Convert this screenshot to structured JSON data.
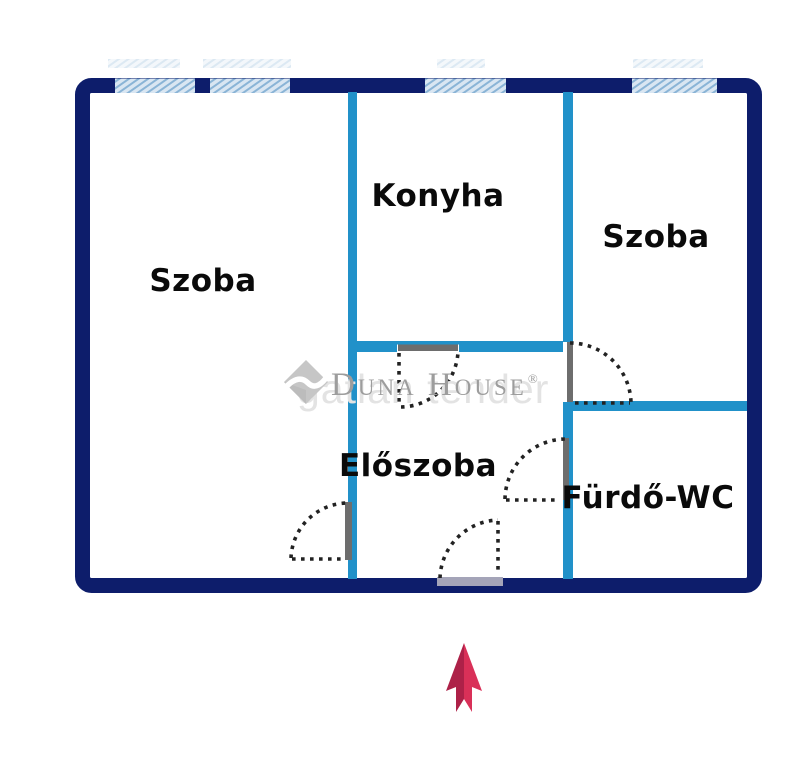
{
  "floorplan_title": "2 szoba lakás alaprajz",
  "rooms": [
    {
      "name": "Szoba"
    },
    {
      "name": "Konyha"
    },
    {
      "name": "Szoba"
    },
    {
      "name": "Előszoba"
    },
    {
      "name": "Fürdő-WC"
    }
  ],
  "watermark": {
    "brand": "Duna House",
    "registered": "®",
    "ghost": "gatlan tender"
  },
  "colors": {
    "outer_wall": "#0d1d6b",
    "inner_wall": "#2191c9",
    "window_fill": "#d9e6f2",
    "window_stripe": "#8ab4d6",
    "door_leaf": "#6d6d6d",
    "door_swing_dots": "#222222",
    "entrance_sill": "#a4a4b8",
    "label_text": "#0a0a0a",
    "watermark_gray": "#9d9d9d",
    "arrow_dark": "#ad2148",
    "arrow_light": "#d93058"
  }
}
